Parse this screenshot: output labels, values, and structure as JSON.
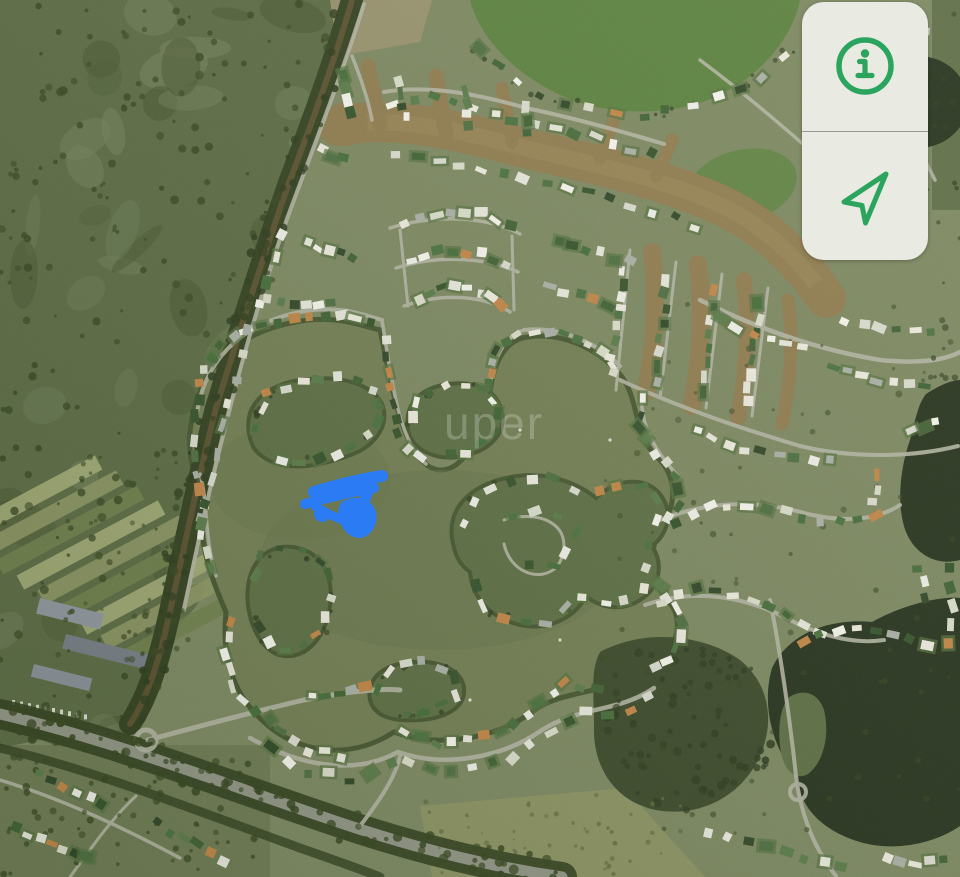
{
  "ui": {
    "controls": {
      "panel_bg": "#e9eae2",
      "divider_color": "#989d92",
      "icon_color": "#2ba45e",
      "buttons": [
        {
          "id": "info",
          "icon": "info-icon"
        },
        {
          "id": "locate",
          "icon": "navigate-arrow-icon"
        }
      ]
    }
  },
  "map": {
    "type": "satellite-imagery",
    "watermark": "uper",
    "annotation": {
      "type": "freehand-scribble",
      "color": "#2b7bf5"
    },
    "colors": {
      "terrain": "#7b8760",
      "wild": "#5a6a43",
      "wild_dark": "#46552f",
      "wild_light": "#72815a",
      "farm": "#8c9663",
      "farm_light": "#a3ac77",
      "farm_dark": "#6f804b",
      "lake": "#717d53",
      "lake_deep": "#667349",
      "island": "#5b6d43",
      "shore_dark": "#45552f",
      "dark_water": "#25311c",
      "forest": "#3a4829",
      "canal": "#8e7a4e",
      "canal_light": "#a18c5c",
      "stream": "#574f2e",
      "treeline": "#31401f",
      "road": "#b2b4a2",
      "road_major": "#909484",
      "dirt": "#99916e",
      "field": "#8b9262",
      "park": "#55803a",
      "tree": "#35451f",
      "tree_dark": "#2b3a1b",
      "scrub": "#5f6d42",
      "boat": "#f2f2ee",
      "warehouse": [
        "#8f969e",
        "#757c85",
        "#888f97"
      ],
      "house_palette": [
        "#edeee6",
        "#f4f4ec",
        "#e6e7db",
        "#dadcca",
        "#eceade",
        "#4c6d3f",
        "#3f6033",
        "#587a48",
        "#33512a",
        "#446b39",
        "#a9afa5",
        "#c08445",
        "#2f4526",
        "#d9dbce",
        "#ece9dd",
        "#49703e"
      ]
    }
  }
}
